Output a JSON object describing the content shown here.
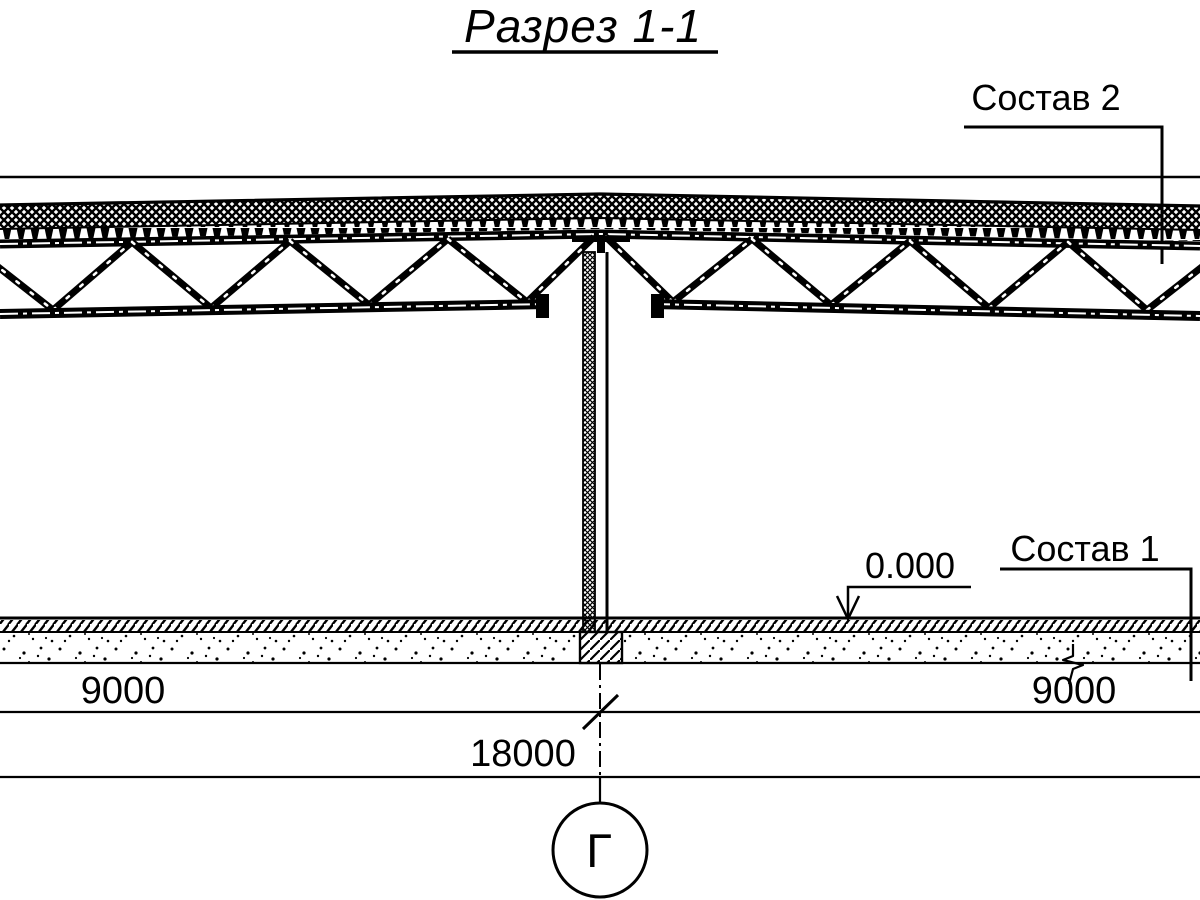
{
  "drawing": {
    "title": "Разрез 1-1",
    "callouts": {
      "roof_composition": "Состав 2",
      "floor_composition": "Состав 1"
    },
    "elevation": {
      "value": "0.000"
    },
    "dimensions": {
      "left_span": "9000",
      "right_span": "9000",
      "total_span": "18000"
    },
    "grid_axis": {
      "label": "Г"
    },
    "colors": {
      "ink": "#000000",
      "paper": "#ffffff"
    }
  }
}
